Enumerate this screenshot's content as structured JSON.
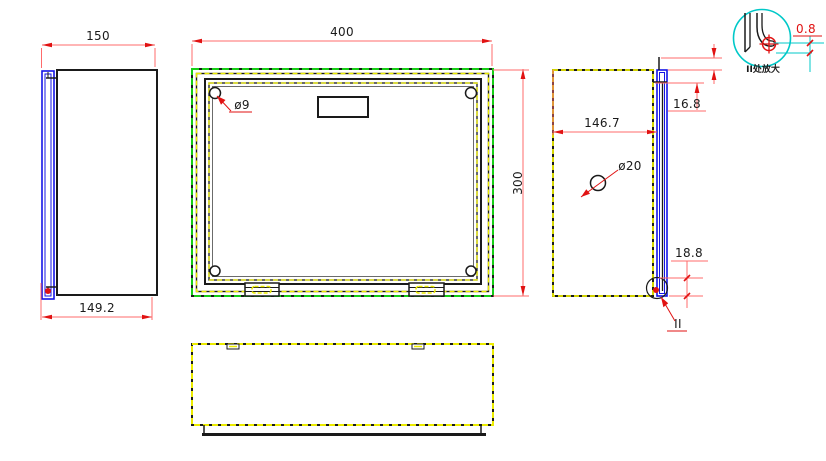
{
  "drawing": {
    "views": {
      "left_view": {
        "name": "left side view",
        "dims": {
          "overall_width": "150",
          "body_width": "149.2"
        }
      },
      "front_view": {
        "name": "front view",
        "dims": {
          "overall_width": "400",
          "overall_height": "300",
          "corner_hole_dia": "ø9"
        }
      },
      "right_view": {
        "name": "right side view",
        "dims": {
          "inner_depth": "146.7",
          "top_hem_offset": "16.8",
          "bottom_hem_offset": "18.8",
          "hole_dia": "ø20",
          "detail_marker": "II"
        }
      },
      "bottom_view": {
        "name": "bottom view",
        "dims": {}
      },
      "detail_view": {
        "name": "detail II enlarged view",
        "caption": "II处放大",
        "dims": {
          "hem_gap": "0.8"
        }
      }
    },
    "colors": {
      "outline": "#1a1a1a",
      "hidden_line_yellow": "#ecec00",
      "sheet_green": "#17cf17",
      "door_blue": "#1414e6",
      "dimension_red": "#ff6b6b",
      "arrow_red": "#e11212",
      "detail_cyan": "#00c8c8",
      "background": "#ffffff"
    }
  }
}
